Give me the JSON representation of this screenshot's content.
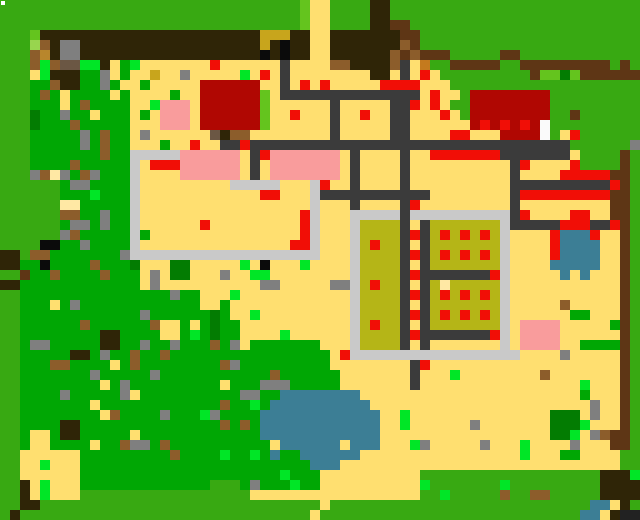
{
  "screen": {
    "width": 640,
    "height": 520
  },
  "map": {
    "cols": 64,
    "rows": 52,
    "tile_size": 10,
    "palette": {
      "G": {
        "color": "#38A912",
        "name": "grass-bright"
      },
      "g": {
        "color": "#00A704",
        "name": "grass-field"
      },
      "d": {
        "color": "#037C02",
        "name": "grass-dark"
      },
      "l": {
        "color": "#64C41E",
        "name": "grass-light"
      },
      "e": {
        "color": "#98D54E",
        "name": "grass-pale"
      },
      "L": {
        "color": "#00E626",
        "name": "lime-plant"
      },
      "Y": {
        "color": "#FFDF70",
        "name": "sand"
      },
      "y": {
        "color": "#FFE8A4",
        "name": "sand-pale"
      },
      "O": {
        "color": "#C8A51C",
        "name": "olive-sand"
      },
      "F": {
        "color": "#B5B517",
        "name": "farmland"
      },
      "B": {
        "color": "#2F2507",
        "name": "dark-earth"
      },
      "w": {
        "color": "#5E3615",
        "name": "wood-brown"
      },
      "b": {
        "color": "#8C5D2B",
        "name": "dirt-brown"
      },
      "u": {
        "color": "#6B5744",
        "name": "gravel-brown"
      },
      "t": {
        "color": "#B8862C",
        "name": "light-brown"
      },
      "o": {
        "color": "#C47A1E",
        "name": "orange-dirt"
      },
      "K": {
        "color": "#0B0B0B",
        "name": "black"
      },
      "S": {
        "color": "#3B3B3B",
        "name": "road-dark"
      },
      "A": {
        "color": "#7F7F7F",
        "name": "stone-gray"
      },
      "P": {
        "color": "#C9C9C9",
        "name": "path-light"
      },
      "W": {
        "color": "#FAFAFA",
        "name": "white-block"
      },
      "R": {
        "color": "#F10E06",
        "name": "red-bright"
      },
      "r": {
        "color": "#B00702",
        "name": "red-building"
      },
      "p": {
        "color": "#F99C9C",
        "name": "pink-roof"
      },
      "C": {
        "color": "#3C7E95",
        "name": "water"
      }
    },
    "grid": [
      "GGGGGGGGGGGGGGGGGGGGGGGGGGGGGGlYYGGGGBBGGGGGGGGGGGGGGGGGGGGGGGGG",
      "GGGGGGGGGGGGGGGGGGGGGGGGGGGGGGlYYGGGGBBGGGGGGGGGGGGGGGGGGGGGGGGG",
      "GGGGGGGGGGGGGGGGGGGGGGGGGGGGGGlYYGGGGBBwwGGGGGGGGGGGGGGGGGGGGGGG",
      "GGGlBBBBBBBBBBBBBBBBBBBBBBOOOBBYYBBBBBBBwwGGGGGGGGGGGGGGGGGGGGGG",
      "GGGebBAABBBBBBBBBBBBBBBBBBOBKBBYYBBBBBBBbwGGGGGGGGGGGGGGGGGGGGGG",
      "GGGbtBAABBBBBBBBBBBBBBBBBBKBKBBYYBBBBBBbwbwwwGGGGGwwGGGGGGGGGGGG",
      "GGGbLbuuLLBYgLYYYYYYYRYYYYYYSYYYYbbBBBBbSYoGGwwwwwGGwwwwwwwwwGwG",
      "GGGYLBBBggAYgYYOYYAYYYYYLYRYSYYYYYYYYBBYSYRYGGGGGGGGGwlldlwwwwww",
      "GGGggbBBggAgYYgYYYYYrrrrrrYYSYRYRYYYYYRRRRYYYGGGGGGGGGGGGGGGGGGG",
      "GGGgbgYggggYgYYYYgYYrrrrrrlYSSSSSSSSSSSSSSYRYYGrrrrrrrrGGGGGGGGG",
      "GGGgggYgbggggYYLpppYrrrrrrlYYYYYYSYYYYYSSRYRYGGrrrrrrrrGGGGGGGGG",
      "GGGdggAggYgggYgYpppYrrrrrrlYYRYYYSYYRYYSSYYYRYGrrrrrrrrGGwGGGGGG",
      "GGGdgggbgggggYYYpppYrrrrrrlYYYYYYSYYYYYSSYYYYYYrRrRrRrWGGGGGGGGG",
      "GGGgggggAgbggYAYYYYYYuBbbYYYYYYYYSYYYYYSSYYYYRRYYYrrrrWGYRGGGGGG",
      "GGGgggggAgbggYYYgYYRYYSSRSSSSSSSSSSSSSSSSSSSSSSSSSSSSSSSSGGGGGGA",
      "GGGgggggggbggPPPPPppppppYSRpppppppYSYYYYSYYRRRRRRRSSSSSSSYGGGGwG",
      "GGGggggbgggggPYRRRppppppYSYpppppppYSYYYYSYYYYYYYYYYSRYYYYRGGGGwG",
      "GGGAbyAgbAgggPYYYYppppppYSYpppppppYSYYYYSYYYYYYYYYYSYYYYRRRRRwwG",
      "GGGGGGgAAggggPYYYYYYYYYPPPPPYYYPRYYSYYYYSYYYYYYYYYYSSSSSSSSSSRwG",
      "GGGGGGgggLgggPYYYYYYYYYYYYRRYYYPSSSSSSSSSSSYYYYYYYYSRRRRRRRRRwwG",
      "GGGGGGyygggggPYYYYYYYYYYYYYYYYYPYYYSYYYYSRYYYYYYYYYSYYYYYYYYYwwG",
      "GGGGGGbbggAggPYYYYYYYYYYYYYYYYRPYYYPPPPPSPPPPPPPPPPSRYYYYRRYYwwG",
      "GGGGGGgAAgAggPYYYYYYRYYYYYYYYYRPYYYPFFFFSYSFFFFFFFPSSSSSRRRSSRwG",
      "GGGGGGAbgggggPgYYYYYYYYYYYYYYYRPYYYPFFFFSRSFRFRFRFPYYYYRCCCRYYwG",
      "GGGGKKggAggggPYYYYYYYYYYYYYYYRRPYYYPFRFFSYSFFFFFFFPYYYYRCCCCYYwG",
      "BBGbbgggggggAPPPPPPPPPPPPPPPPPPPYYYPFFFFSRSFRFRFRFPYYYYRCCCCYYwG",
      "BBggKggggbgggdYYYddYYYYYLYKYYYLYYYYPFFFFSYSFFFFFFFPYYYYCCCCCYYwG",
      "GGwggbggggbgggYAYddYYYAYYLLYYYYYYYYPFFFFSRSSSSSSSRPYYYYYCYCYYYwG",
      "BBggggggggggggYAYYYYYYYYYYAAYYYYYAAPFRFFSYSFyFFFFFPYYYYYYYYYYYwG",
      "GGgggggggggggggggAggYYYLYYYYYYYYYYYPFFFFSRSFRFRFRFPYYYYYYYYYYYwG",
      "GGgggYgAggggggggggggYYgYYYYYYYYYYYYPFFFFSYSFFFFFFFPYYYYYbYYYYYwG",
      "GGggggggggggggAggggggdgYYLYYYYYYYYYPFFFFSRSFRFRFRFPYYYYYYggYYYwG",
      "GGggggggbggggggbYYgYgdggYYYYYYYYYYYPFRFFSYSFFFFFFFPYppppYYYYYgwG",
      "GGggggggggBBggggYYgLgdggYYYYLYYYYYYPFFFFSRSSSSSSSRPYppppYYYYYYwG",
      "GGgAAgggggBBggAggAgggbgAYgggggggYYYPFFFFSYSYYYYYYYPYppppYYggggwG",
      "GGgggggBBgAggbggbggggggggggggggggYRPPPPPPPPPPPPPPPPPYYYYAYYYYYwG",
      "GGgggbbggggYgbggggggggbAgggggggggYYYYYYYYSRYYYYYYYYYYYYYYYYYYYwG",
      "GGgggggggAgggggAgggggggggggbggggggYYYYYYYSYYYLYYYYYYYYbYYYYYYYwG",
      "GGggggggggYgAgggggggggYgggAAAgggggYYYYYYYSYYYYYYYYYYYYYYYYLYYYwG",
      "GGggggAgggggAYggggggggggAAggCCCCCCCCYYYYYYYYYYYYYYYYYYYYYYgYYYwG",
      "GGgggggggYggggggggggggbggLgCCCCCCCCCCYYYYYYYYYYYYYYYYYYYYYYAYYwG",
      "GGggggggggYbggggAgggLAggggCCCCCCCCCCCCYYLYYYYYYYYYYYYYYdddYAYYwG",
      "GGggggBBggggggggggggggbgbgCCCCCCCCCCCCYYLYYYYYYAYYYYYYYdddLYYYwG",
      "GGgYYgBBgggggYggggggggggggCCCCCCCCCCCCYYYYYYYYYYYYYYYYYddLYAbwwG",
      "GGgYYggggYggbAAgbggggggggggYCCCCCCYCCCYYYLAYYYYYAYYYLYYYYAYYYwwG",
      "GGYYYYYYgggggggggbggggLggLgCggCCCCCCYYYYYYYYYYYYYYYYLYYYggYYYYGG",
      "GGYYLYYYgggggggggggggggggggggggCCCYYYYYYYYYYYYYYYYYYYYYYYYYYYYGG",
      "GGYYYYYYggggggggggggggggggggLgggYYYYYYYYYYGGGGGGGGGGGGGGGGGGBBBL",
      "GGBYLYYYgggggggggggggGGGgAgggLggYYYYYYYYYYLGGGGGGGLGGGGGGGGGBBBB",
      "GGBYLYYYGGGGGGGGGGGGGGGGGYYYYYYYYYYYYYYYYYGGLGGGGGbGGbbGGGGGBBBB",
      "GGBBGGGGGGGGGGGGGGGGGGGGGGGGGGGGYGGGGGGGGGGGGGGGGGGGGGGGGGGCCYB",
      "GGBGGGGGGGGGGGGGGGGGGGGGGGGGGGGGYGGGGGGGGGGGGGGGGGGGGGGGGGGCCYB"
    ],
    "cursor_marker": {
      "x": 1,
      "y": 1,
      "size": 4,
      "color": "#FFFFFF"
    }
  }
}
